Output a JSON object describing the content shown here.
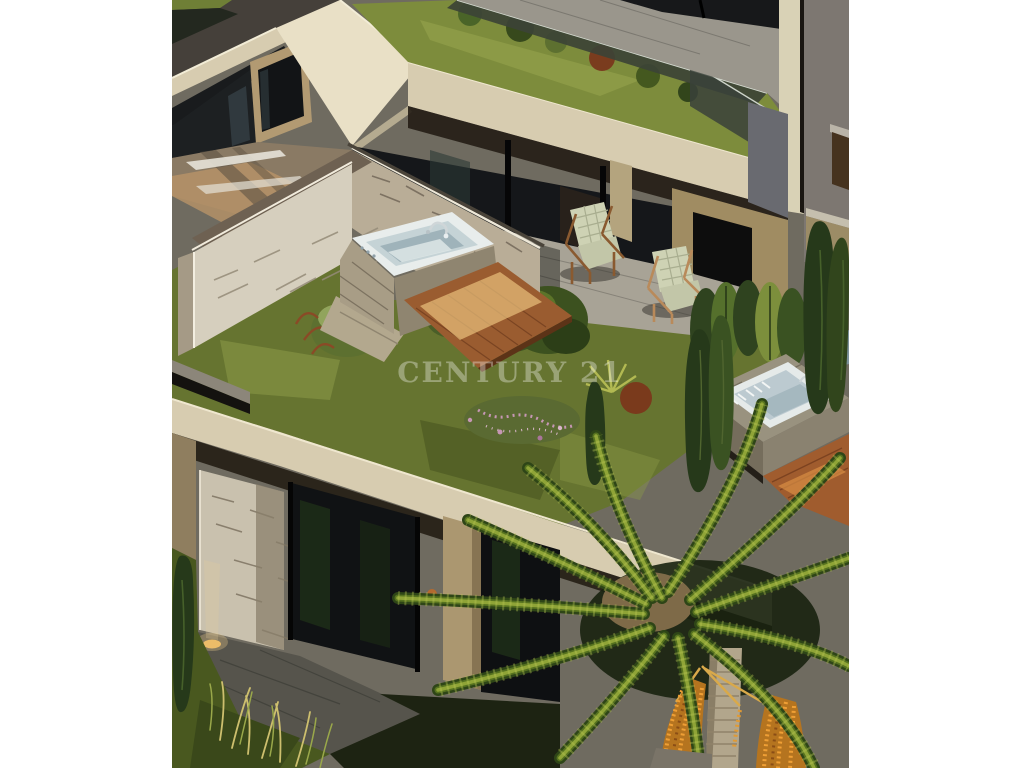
{
  "window": {
    "kind": "real-estate listing photo",
    "description": "Aerial 3D architectural rendering of modern terraced hillside residences with rooftop gardens, an outdoor jacuzzi terrace with lounge chairs, cypress trees and a date palm"
  },
  "photo": {
    "x": 172,
    "y": 0,
    "width": 677,
    "height": 768
  },
  "watermark": {
    "text": "CENTURY 21"
  },
  "palette": {
    "page_bg": "#ffffff",
    "photo_base": "#6f6b60",
    "cream_slab": "#d7ccb0",
    "cream_slab_light": "#e9e0c6",
    "beige_stucco": "#b29a72",
    "tan_wall": "#a08c62",
    "grey_wall": "#7d7771",
    "dark_glass": "#15171a",
    "paving_light": "#a8a396",
    "paving_shadow": "#5c5a52",
    "stone_light": "#d6cfbe",
    "stone_joint": "#8a8172",
    "lawn_green": "#667430",
    "lawn_light": "#8d9a48",
    "bush_dark": "#34491d",
    "cypress_dark": "#26391a",
    "flower_pink": "#c697b4",
    "tub_white": "#e8edec",
    "tub_basin": "#c5d3d6",
    "deck_wood": "#9a5c30",
    "deck_glint": "#eac07c",
    "palm_dark": "#2e4517",
    "trunk": "#b2a68c",
    "date_orange": "#e09a35",
    "watermark_white": "rgba(255,255,255,0.34)"
  },
  "scene": {
    "elements": [
      {
        "name": "upper-left-terrace",
        "label": "upper neighbour terrace with stucco wall and glass doors"
      },
      {
        "name": "roof-garden-strip",
        "label": "green roof strip with shrubs behind glass balustrade"
      },
      {
        "name": "roof-slab-fascia",
        "label": "cream concrete roof slab fascia"
      },
      {
        "name": "lounge-terrace",
        "label": "covered terrace with two cushioned wooden lounge chairs"
      },
      {
        "name": "stone-wall",
        "label": "fieldstone privacy wall and pillar"
      },
      {
        "name": "jacuzzi",
        "label": "white outdoor jacuzzi on stone platform with chrome faucet"
      },
      {
        "name": "wood-deck",
        "label": "sunlit timber deck"
      },
      {
        "name": "rooftop-garden",
        "label": "rooftop lawn with bushes and pink flowers"
      },
      {
        "name": "lower-apartment",
        "label": "lower floor apartment with glass walls and ground terrace"
      },
      {
        "name": "terrace-2",
        "label": "neighbouring terrace with second jacuzzi and deck"
      },
      {
        "name": "cypress-trees",
        "label": "columnar cypress hedge"
      },
      {
        "name": "palm-tree",
        "label": "date palm with orange fruit clusters"
      }
    ]
  }
}
